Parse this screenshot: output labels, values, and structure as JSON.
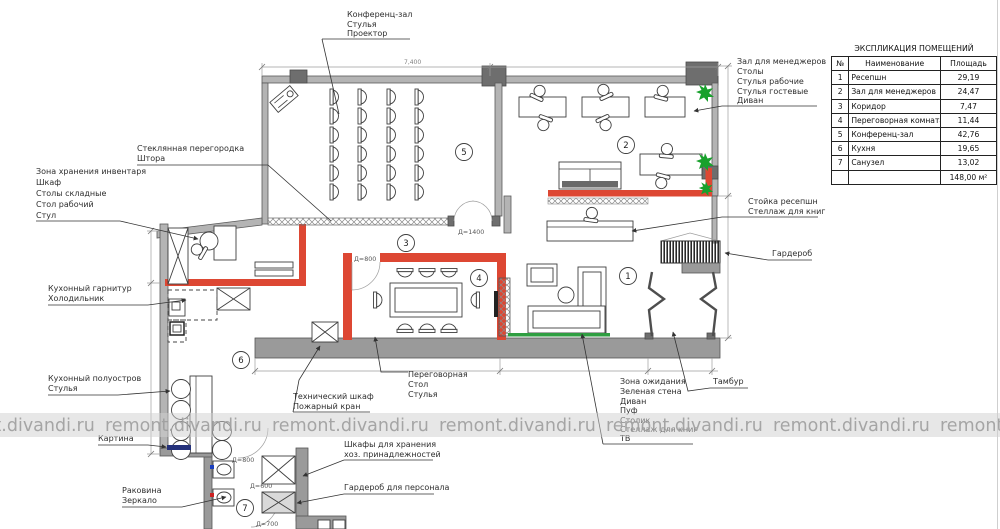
{
  "watermark": {
    "text": "remont.divandi.ru"
  },
  "explication": {
    "title": "ЭКСПЛИКАЦИЯ ПОМЕЩЕНИЙ",
    "col_num": "№",
    "col_name": "Наименование",
    "col_area": "Площадь",
    "rows": [
      {
        "num": "1",
        "name": "Ресепшн",
        "area": "29,19"
      },
      {
        "num": "2",
        "name": "Зал для менеджеров",
        "area": "24,47"
      },
      {
        "num": "3",
        "name": "Коридор",
        "area": "7,47"
      },
      {
        "num": "4",
        "name": "Переговорная комната",
        "area": "11,44"
      },
      {
        "num": "5",
        "name": "Конференц-зал",
        "area": "42,76"
      },
      {
        "num": "6",
        "name": "Кухня",
        "area": "19,65"
      },
      {
        "num": "7",
        "name": "Санузел",
        "area": "13,02"
      }
    ],
    "total_area": "148,00 м²"
  },
  "rooms": [
    "1",
    "2",
    "3",
    "4",
    "5",
    "6",
    "7"
  ],
  "dims": {
    "conf_width": "7,400",
    "door_conf": "Д=1400",
    "door_meeting": "Д=800",
    "door_bath1": "Д=800",
    "door_bath2": "Д=600",
    "door_bath3": "Д=700"
  },
  "callouts": {
    "conference": {
      "lines": [
        "Конференц-зал",
        "Стулья",
        "Проектор"
      ]
    },
    "glass_partition": {
      "lines": [
        "Стеклянная перегородка",
        "Штора"
      ]
    },
    "storage_zone": {
      "lines": [
        "Зона хранения инвентаря",
        "Шкаф",
        "Столы складные",
        "Стол рабочий",
        "Стул"
      ]
    },
    "kitchen_set": {
      "lines": [
        "Кухонный гарнитур",
        "Холодильник"
      ]
    },
    "kitchen_peninsula": {
      "lines": [
        "Кухонный полуостров",
        "Стулья"
      ]
    },
    "picture": {
      "lines": [
        "Картина"
      ]
    },
    "sink": {
      "lines": [
        "Раковина",
        "Зеркало"
      ]
    },
    "tech_closet": {
      "lines": [
        "Технический шкаф",
        "Пожарный кран"
      ]
    },
    "meeting_room": {
      "lines": [
        "Переговорная",
        "Стол",
        "Стулья"
      ]
    },
    "storage_cabinets": {
      "lines": [
        "Шкафы для хранения",
        "хоз. принадлежностей"
      ]
    },
    "staff_wardrobe": {
      "lines": [
        "Гардероб для персонала"
      ]
    },
    "waiting_zone": {
      "lines": [
        "Зона ожидания",
        "Зеленая стена",
        "Диван",
        "Пуф",
        "Столик",
        "Стеллаж для книг",
        "ТВ"
      ]
    },
    "tambour": {
      "lines": [
        "Тамбур"
      ]
    },
    "managers_hall": {
      "lines": [
        "Зал для менеджеров",
        "Столы",
        "Стулья рабочие",
        "Стулья гостевые",
        "Диван"
      ]
    },
    "reception_desk": {
      "lines": [
        "Стойка ресепшн",
        "Стеллаж для книг"
      ]
    },
    "wardrobe": {
      "lines": [
        "Гардероб"
      ]
    }
  },
  "colors": {
    "partition_red": "#dd4733",
    "plant_green": "#18a12c",
    "green_wall": "#2f9e41",
    "wall_gray": "#9a9a9a"
  }
}
